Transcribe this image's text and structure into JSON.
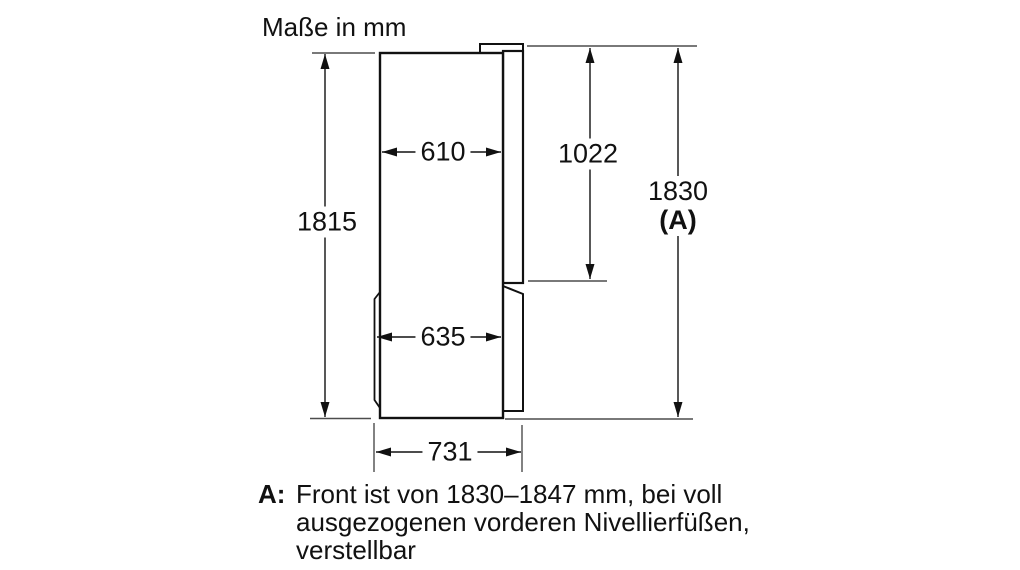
{
  "title": "Maße in mm",
  "labels": {
    "body_height": "1815",
    "body_depth": "610",
    "upper_door_height": "1022",
    "overall_height": "1830",
    "overall_height_suffix": "(A)",
    "lower_section_depth": "635",
    "overall_depth": "731"
  },
  "footnote": {
    "marker": "A:",
    "lines": [
      "Front ist von 1830–1847 mm, bei voll",
      "ausgezogenen vorderen Nivellierfüßen,",
      "verstellbar"
    ]
  },
  "colors": {
    "background": "#ffffff",
    "outline": "#111111",
    "reference_line": "#4d4d4d",
    "text": "#111111"
  }
}
